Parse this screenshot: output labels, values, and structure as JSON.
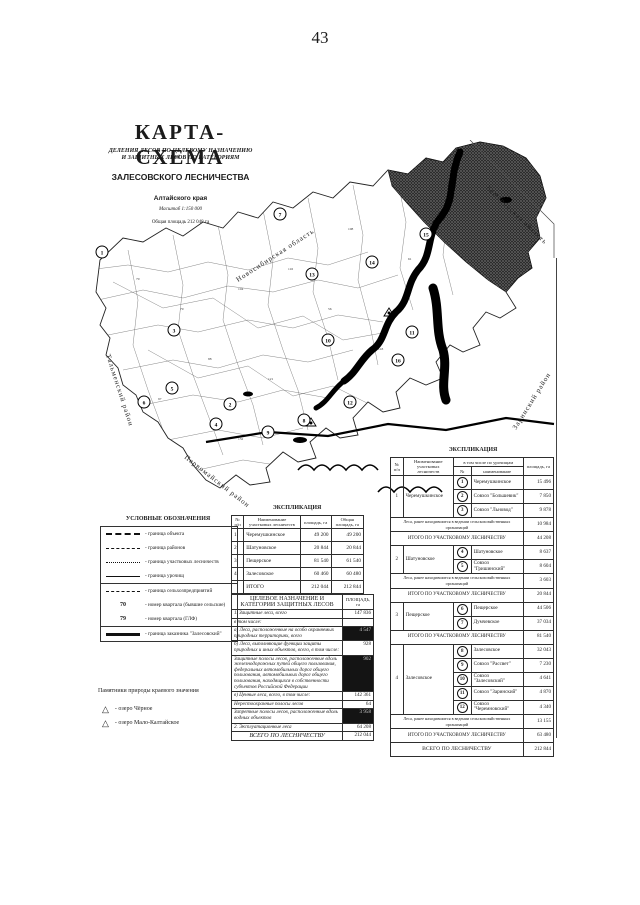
{
  "page": {
    "number": "43"
  },
  "title": {
    "main": "КАРТА-СХЕМА",
    "subtitle_line1": "ДЕЛЕНИЯ ЛЕСОВ ПО ЦЕЛЕВОМУ НАЗНАЧЕНИЮ",
    "subtitle_line2": "И ЗАЩИТНЫХ ЛЕСОВ ПО КАТЕГОРИЯМ",
    "forestry": "ЗАЛЕСОВСКОГО ЛЕСНИЧЕСТВА",
    "region": "Алтайского края",
    "scale": "Масштаб 1:150 000",
    "total_area": "Общая площадь 212 048 га"
  },
  "map": {
    "labels": {
      "novosibirsk": "Новосибирская область",
      "kemerovo": "Кемеровская область",
      "talmensky": "Тальменский район",
      "pervomaysky": "Первомайский район",
      "zarinsky": "Заринский район"
    },
    "markers": [
      "1",
      "2",
      "3",
      "4",
      "5",
      "6",
      "7",
      "8",
      "9",
      "10",
      "11",
      "12",
      "13",
      "14",
      "15",
      "16"
    ],
    "quarter_numbers": [
      "70",
      "79",
      "104",
      "116",
      "88",
      "121",
      "56",
      "143",
      "97",
      "132",
      "61",
      "108"
    ]
  },
  "legend": {
    "title": "УСЛОВНЫЕ ОБОЗНАЧЕНИЯ",
    "items": [
      {
        "label": "- граница объекта"
      },
      {
        "label": "- граница районов"
      },
      {
        "label": "- граница участковых лесничеств"
      },
      {
        "label": "- граница урочищ"
      },
      {
        "label": "- граница сельхозпредприятий"
      },
      {
        "symbol": "70",
        "label": "- номер квартала (бывшие сельские)"
      },
      {
        "symbol": "79",
        "label": "- номер квартала (ГЛФ)"
      },
      {
        "label": "- граница заказника \"Залесовский\""
      }
    ],
    "monuments_title": "Памятники природы краевого значения",
    "monuments": [
      {
        "label": "- озеро Чёрное"
      },
      {
        "label": "- озеро Мало-Калтайское"
      }
    ]
  },
  "explication_center": {
    "title": "ЭКСПЛИКАЦИЯ",
    "columns": {
      "n": "№ п/п",
      "name": "Наименование участковых лесничеств",
      "area": "площадь, га",
      "total": "Общая площадь, га"
    },
    "rows": [
      [
        "1",
        "Черемушкинское",
        "49 200",
        "49 200"
      ],
      [
        "2",
        "Шатуновское",
        "20 844",
        "20 844"
      ],
      [
        "3",
        "Пещерское",
        "81 540",
        "61 540"
      ],
      [
        "4",
        "Залесовское",
        "60 460",
        "60 480"
      ],
      [
        "",
        "ИТОГО",
        "212 044",
        "212 844"
      ]
    ]
  },
  "purpose_table": {
    "header_left": "ЦЕЛЕВОЕ НАЗНАЧЕНИЕ И КАТЕГОРИИ ЗАЩИТНЫХ ЛЕСОВ",
    "header_right": "ПЛОЩАДЬ, га",
    "rows": [
      {
        "label": "1. Защитные леса, всего",
        "value": "147 836"
      },
      {
        "label": "в том числе:",
        "value": ""
      },
      {
        "label": "а) Леса, расположенные на особо охраняемых природных территориях, всего",
        "value": "4 547"
      },
      {
        "label": "б) Леса, выполняющие функции защиты природных и иных объектов, всего, в том числе:",
        "value": "928"
      },
      {
        "label": "Защитные полосы лесов, расположенные вдоль железнодорожных путей общего пользования, федеральных автомобильных дорог общего пользования, автомобильных дорог общего пользования, находящихся в собственности субъектов Российской Федерации",
        "value": "902"
      },
      {
        "label": "в) Ценные леса, всего, в том числе:",
        "value": "142 361"
      },
      {
        "label": "Нерестоохранные полосы лесов",
        "value": "64"
      },
      {
        "label": "Запретные полосы лесов, расположенные вдоль водных объектов",
        "value": "3 958"
      },
      {
        "label": "2. Эксплуатационные леса",
        "value": "64 208"
      }
    ],
    "total_label": "ВСЕГО ПО ЛЕСНИЧЕСТВУ",
    "total_value": "212 044"
  },
  "explication_right": {
    "title": "ЭКСПЛИКАЦИЯ",
    "columns": {
      "no": "№ п/п",
      "name": "Наименование участковых лесничеств",
      "incl": "в том числе по урочищам",
      "n": "№",
      "iname": "наименование",
      "area": "площадь, га"
    },
    "former_label": "Леса, ранее находившиеся в ведении сельскохозяйственных организаций",
    "itogo_label": "ИТОГО ПО УЧАСТКОВОМУ ЛЕСНИЧЕСТВУ",
    "sections": [
      {
        "no": "1",
        "name": "Черемушкинское",
        "items": [
          {
            "n": "1",
            "label": "Черемушкинское",
            "area": "15 496"
          },
          {
            "n": "2",
            "label": "Совхоз \"Большевик\"",
            "area": "7 850"
          },
          {
            "n": "3",
            "label": "Совхоз \"Льновод\"",
            "area": "9 878"
          }
        ],
        "former": "10 984",
        "total": "44 208"
      },
      {
        "no": "2",
        "name": "Шатуновское",
        "items": [
          {
            "n": "4",
            "label": "Шатуновское",
            "area": "8 637"
          },
          {
            "n": "5",
            "label": "Совхоз \"Гришинский\"",
            "area": "8 604"
          }
        ],
        "former": "3 603",
        "total": "20 844"
      },
      {
        "no": "3",
        "name": "Пещерское",
        "items": [
          {
            "n": "6",
            "label": "Пещерское",
            "area": "44 506"
          },
          {
            "n": "7",
            "label": "Думчевское",
            "area": "37 034"
          }
        ],
        "former": "",
        "total": "81 540"
      },
      {
        "no": "4",
        "name": "Залесовское",
        "items": [
          {
            "n": "8",
            "label": "Залесовское",
            "area": "32 043"
          },
          {
            "n": "9",
            "label": "Совхоз \"Рассвет\"",
            "area": "7 230"
          },
          {
            "n": "10",
            "label": "Совхоз \"Залесовский\"",
            "area": "4 641"
          },
          {
            "n": "11",
            "label": "Совхоз \"Заринский\"",
            "area": "4 870"
          },
          {
            "n": "12",
            "label": "Совхоз \"Черемновский\"",
            "area": "4 340"
          }
        ],
        "former": "13 155",
        "total": "63 480"
      }
    ],
    "vsego_label": "ВСЕГО ПО ЛЕСНИЧЕСТВУ",
    "vsego_value": "212 844"
  }
}
